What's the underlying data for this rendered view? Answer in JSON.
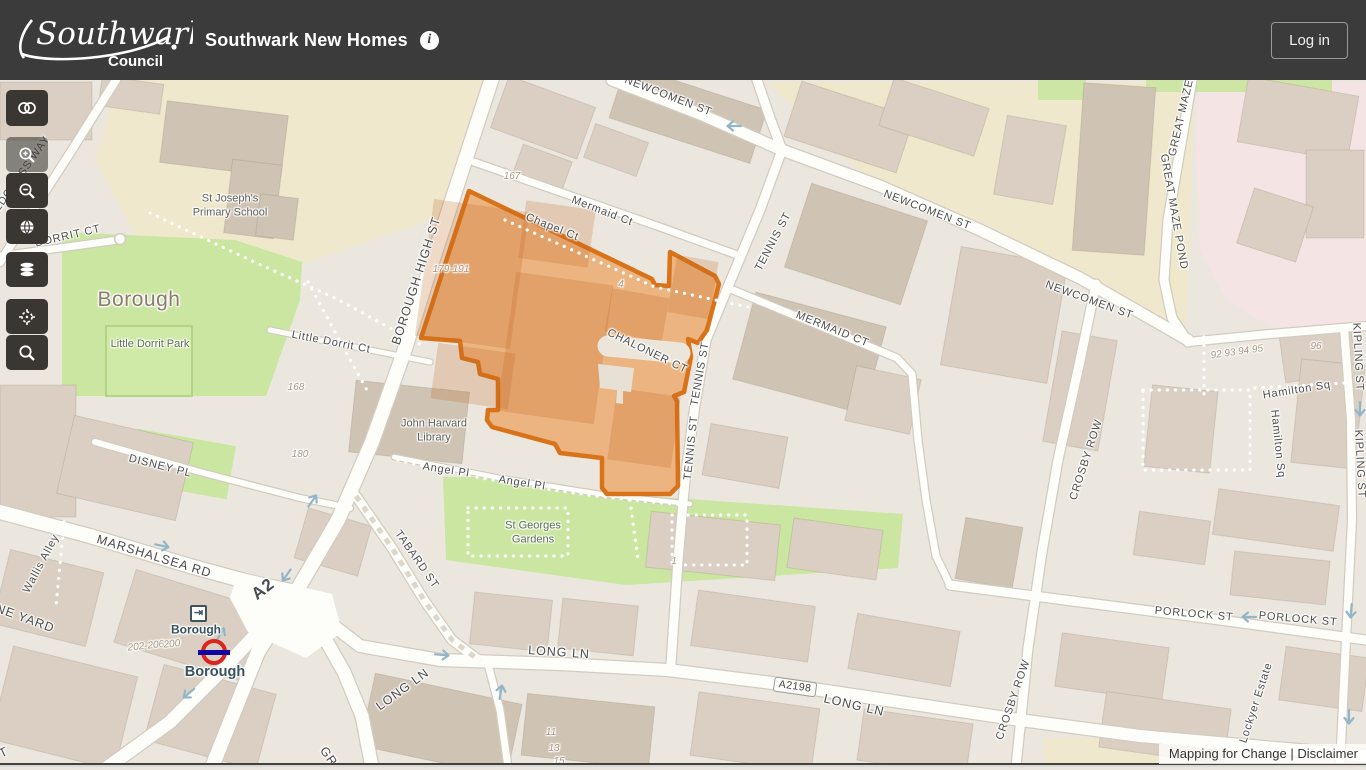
{
  "header": {
    "logo_line1": "Southwark",
    "logo_line2": "Council",
    "title": "Southwark New Homes",
    "info_icon": "info-icon",
    "login_label": "Log in"
  },
  "toolbar": {
    "buttons": [
      {
        "name": "swipe-compare",
        "icon": "swipe-icon"
      },
      {
        "name": "zoom-in",
        "icon": "zoom-in-icon"
      },
      {
        "name": "zoom-out",
        "icon": "zoom-out-icon"
      },
      {
        "name": "full-extent",
        "icon": "globe-icon"
      },
      {
        "name": "layers",
        "icon": "layers-icon"
      },
      {
        "name": "locate",
        "icon": "crosshair-icon"
      },
      {
        "name": "search",
        "icon": "search-icon"
      }
    ]
  },
  "map": {
    "highlight_color": "#d9731a",
    "labels": [
      {
        "t": "REDCROSS WAY",
        "x": 20,
        "y": 178,
        "r": -55,
        "c": "street"
      },
      {
        "t": "DORRIT CT",
        "x": 68,
        "y": 237,
        "r": -13,
        "c": "street"
      },
      {
        "t": "BOROUGH HIGH ST",
        "x": 417,
        "y": 281,
        "r": -72,
        "c": "street-lg"
      },
      {
        "t": "Mermaid Ct",
        "x": 602,
        "y": 212,
        "r": 21,
        "c": "street"
      },
      {
        "t": "Chapel Ct",
        "x": 552,
        "y": 228,
        "r": 22,
        "c": "street"
      },
      {
        "t": "TENNIS ST",
        "x": 774,
        "y": 242,
        "r": -62,
        "c": "street"
      },
      {
        "t": "TENNIS ST",
        "x": 701,
        "y": 374,
        "r": -80,
        "c": "street"
      },
      {
        "t": "TENNIS ST",
        "x": 692,
        "y": 448,
        "r": -84,
        "c": "street"
      },
      {
        "t": "CHALONER CT",
        "x": 647,
        "y": 352,
        "r": 26,
        "c": "street"
      },
      {
        "t": "MERMAID CT",
        "x": 832,
        "y": 330,
        "r": 22,
        "c": "street"
      },
      {
        "t": "NEWCOMEN ST",
        "x": 668,
        "y": 97,
        "r": 21,
        "c": "street"
      },
      {
        "t": "NEWCOMEN ST",
        "x": 927,
        "y": 211,
        "r": 21,
        "c": "street"
      },
      {
        "t": "NEWCOMEN ST",
        "x": 1089,
        "y": 301,
        "r": 20,
        "c": "street"
      },
      {
        "t": "GREAT MAZE",
        "x": 1182,
        "y": 118,
        "r": -77,
        "c": "street"
      },
      {
        "t": "GREAT MAZE POND",
        "x": 1173,
        "y": 212,
        "r": 80,
        "c": "street"
      },
      {
        "t": "KIPLING ST",
        "x": 1357,
        "y": 357,
        "r": 87,
        "c": "street"
      },
      {
        "t": "KIPLING ST",
        "x": 1359,
        "y": 464,
        "r": 87,
        "c": "street"
      },
      {
        "t": "CROSBY ROW",
        "x": 1087,
        "y": 460,
        "r": -72,
        "c": "street"
      },
      {
        "t": "CROSBY ROW",
        "x": 1014,
        "y": 700,
        "r": -71,
        "c": "street"
      },
      {
        "t": "PORLOCK ST",
        "x": 1194,
        "y": 615,
        "r": 5,
        "c": "street"
      },
      {
        "t": "PORLOCK ST",
        "x": 1298,
        "y": 620,
        "r": 5,
        "c": "street"
      },
      {
        "t": "Hamilton Sq",
        "x": 1297,
        "y": 391,
        "r": -9,
        "c": "street"
      },
      {
        "t": "Hamilton Sq",
        "x": 1277,
        "y": 444,
        "r": 84,
        "c": "street"
      },
      {
        "t": "MARSHALSEA RD",
        "x": 154,
        "y": 557,
        "r": 17,
        "c": "street-lg"
      },
      {
        "t": "DISNEY PL",
        "x": 160,
        "y": 467,
        "r": 14,
        "c": "street"
      },
      {
        "t": "Wallis Alley",
        "x": 42,
        "y": 564,
        "r": -62,
        "c": "street"
      },
      {
        "t": "NE YARD",
        "x": 25,
        "y": 619,
        "r": 20,
        "c": "street-lg"
      },
      {
        "t": "TABARD ST",
        "x": 416,
        "y": 560,
        "r": 55,
        "c": "street"
      },
      {
        "t": "LONG LN",
        "x": 559,
        "y": 653,
        "r": 4,
        "c": "street-lg"
      },
      {
        "t": "LONG LN",
        "x": 403,
        "y": 690,
        "r": -36,
        "c": "street-lg"
      },
      {
        "t": "LONG LN",
        "x": 854,
        "y": 706,
        "r": 13,
        "c": "street-lg"
      },
      {
        "t": "Angel Pl",
        "x": 446,
        "y": 471,
        "r": 9,
        "c": "street"
      },
      {
        "t": "Angel Pl",
        "x": 522,
        "y": 484,
        "r": 9,
        "c": "street"
      },
      {
        "t": "Little Dorrit Ct",
        "x": 331,
        "y": 343,
        "r": 11,
        "c": "street"
      },
      {
        "t": "Lockyer Estate",
        "x": 1257,
        "y": 703,
        "r": -72,
        "c": "street"
      },
      {
        "t": "GR",
        "x": 328,
        "y": 757,
        "r": 55,
        "c": "street-lg"
      },
      {
        "t": "T",
        "x": 4,
        "y": 753,
        "r": -25,
        "c": "street-lg"
      },
      {
        "t": "St Joseph's\nPrimary School",
        "x": 230,
        "y": 206,
        "r": 0,
        "c": "poi"
      },
      {
        "t": "John Harvard\nLibrary",
        "x": 434,
        "y": 431,
        "r": 0,
        "c": "poi"
      },
      {
        "t": "St Georges\nGardens",
        "x": 533,
        "y": 533,
        "r": 0,
        "c": "park"
      },
      {
        "t": "Little Dorrit Park",
        "x": 150,
        "y": 345,
        "r": 0,
        "c": "park"
      },
      {
        "t": "Borough",
        "x": 139,
        "y": 300,
        "r": 0,
        "c": "place"
      },
      {
        "t": "167",
        "x": 512,
        "y": 177,
        "r": 0,
        "c": "num"
      },
      {
        "t": "179-191",
        "x": 451,
        "y": 270,
        "r": 0,
        "c": "num"
      },
      {
        "t": "4",
        "x": 621,
        "y": 285,
        "r": 0,
        "c": "num"
      },
      {
        "t": "168",
        "x": 296,
        "y": 388,
        "r": 0,
        "c": "num"
      },
      {
        "t": "180",
        "x": 300,
        "y": 455,
        "r": 0,
        "c": "num"
      },
      {
        "t": "1",
        "x": 674,
        "y": 562,
        "r": 0,
        "c": "num"
      },
      {
        "t": "92 93 94 95",
        "x": 1237,
        "y": 353,
        "r": -8,
        "c": "num"
      },
      {
        "t": "96",
        "x": 1316,
        "y": 347,
        "r": 0,
        "c": "num"
      },
      {
        "t": "202-206",
        "x": 146,
        "y": 647,
        "r": -6,
        "c": "num"
      },
      {
        "t": "200",
        "x": 172,
        "y": 645,
        "r": -6,
        "c": "num"
      },
      {
        "t": "11",
        "x": 551,
        "y": 733,
        "r": 0,
        "c": "num"
      },
      {
        "t": "13",
        "x": 554,
        "y": 749,
        "r": 0,
        "c": "num"
      },
      {
        "t": "15",
        "x": 559,
        "y": 762,
        "r": 0,
        "c": "num"
      },
      {
        "t": "Borough",
        "x": 196,
        "y": 630,
        "r": 0,
        "c": "station"
      },
      {
        "t": "Borough",
        "x": 215,
        "y": 672,
        "r": 0,
        "c": "station-lg"
      },
      {
        "t": "A2198",
        "x": 795,
        "y": 687,
        "r": 8,
        "c": "ref"
      },
      {
        "t": "A2",
        "x": 263,
        "y": 589,
        "r": -38,
        "c": "ref-big"
      }
    ],
    "one_way_arrows": [
      {
        "x": 733,
        "y": 126,
        "r": 180
      },
      {
        "x": 163,
        "y": 546,
        "r": 12
      },
      {
        "x": 221,
        "y": 633,
        "r": -60
      },
      {
        "x": 188,
        "y": 694,
        "r": 140
      },
      {
        "x": 313,
        "y": 500,
        "r": -55
      },
      {
        "x": 286,
        "y": 576,
        "r": 125
      },
      {
        "x": 443,
        "y": 655,
        "r": 5
      },
      {
        "x": 501,
        "y": 691,
        "r": -80
      },
      {
        "x": 1248,
        "y": 617,
        "r": 180
      },
      {
        "x": 1360,
        "y": 410,
        "r": 90
      },
      {
        "x": 1351,
        "y": 612,
        "r": 95
      },
      {
        "x": 1349,
        "y": 718,
        "r": 90
      }
    ],
    "station": {
      "name": "Borough",
      "roundel": {
        "x": 214,
        "y": 652
      },
      "entrance": {
        "x": 198,
        "y": 613,
        "glyph": "⇥"
      }
    },
    "attribution": {
      "link1": "Mapping for Change",
      "sep": " | ",
      "link2": "Disclaimer"
    }
  }
}
